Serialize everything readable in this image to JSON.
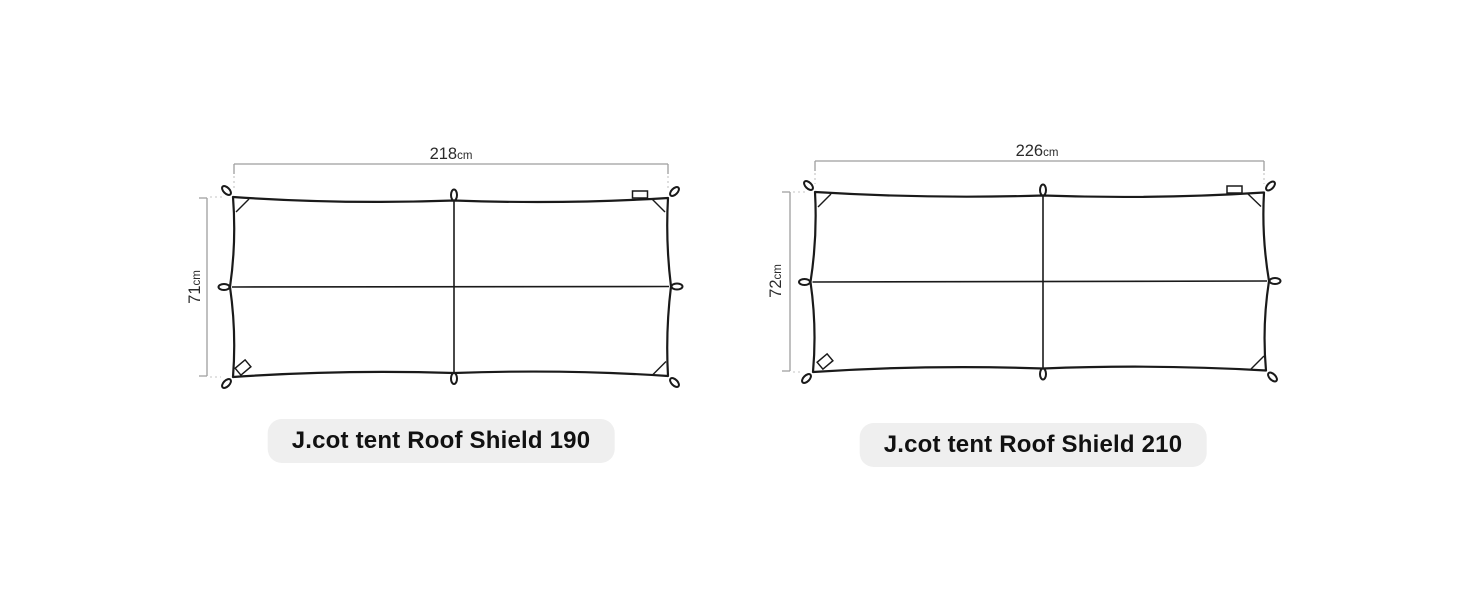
{
  "page": {
    "background_color": "#ffffff"
  },
  "products": [
    {
      "title": "J.cot tent Roof Shield 190",
      "width": {
        "value": "218",
        "unit": "cm"
      },
      "depth": {
        "value": "71",
        "unit": "cm"
      }
    },
    {
      "title": "J.cot tent Roof Shield 210",
      "width": {
        "value": "226",
        "unit": "cm"
      },
      "depth": {
        "value": "72",
        "unit": "cm"
      }
    }
  ],
  "icons": {
    "corner_loop_icon": "tie-down loop at each corner",
    "edge_loop_icon": "tie-down loop at each edge midpoint",
    "brand_tag_icon": "small fabric tag on top edge near right corner",
    "logo_patch_icon": "tilted logo patch near bottom-left corner"
  },
  "colors": {
    "outline": "#1a1a1a",
    "dimension_line": "#9e9e9e",
    "dotted_line": "#c4c4c4",
    "label_text": "#2b2b2b",
    "pill_background": "#efefef",
    "pill_text": "#111111"
  }
}
